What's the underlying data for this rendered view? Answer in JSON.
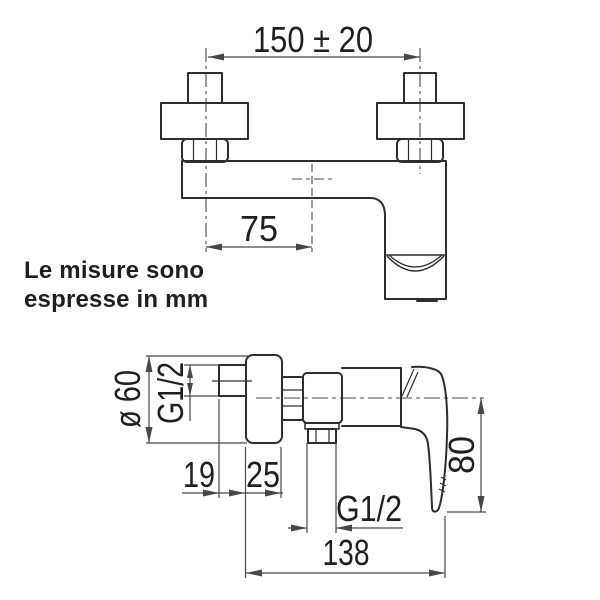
{
  "title": "Technical drawing of a wall-mounted single-lever shower mixer with dimensions",
  "note": {
    "line1": "Le misure sono",
    "line2": "espresse in mm"
  },
  "dimensions": {
    "front_view": {
      "mounting_distance": "150 ± 20",
      "spout_center_offset": "75"
    },
    "side_view": {
      "escutcheon_diameter": "ø 60",
      "inlet_thread": "G1/2",
      "wall_clearance": "19",
      "escutcheon_depth": "25",
      "outlet_thread": "G1/2",
      "handle_drop": "80",
      "total_depth": "138"
    }
  },
  "colors": {
    "line": "#2d2d2d",
    "dim": "#474747",
    "text": "#1f1f1f",
    "background": "#ffffff"
  }
}
